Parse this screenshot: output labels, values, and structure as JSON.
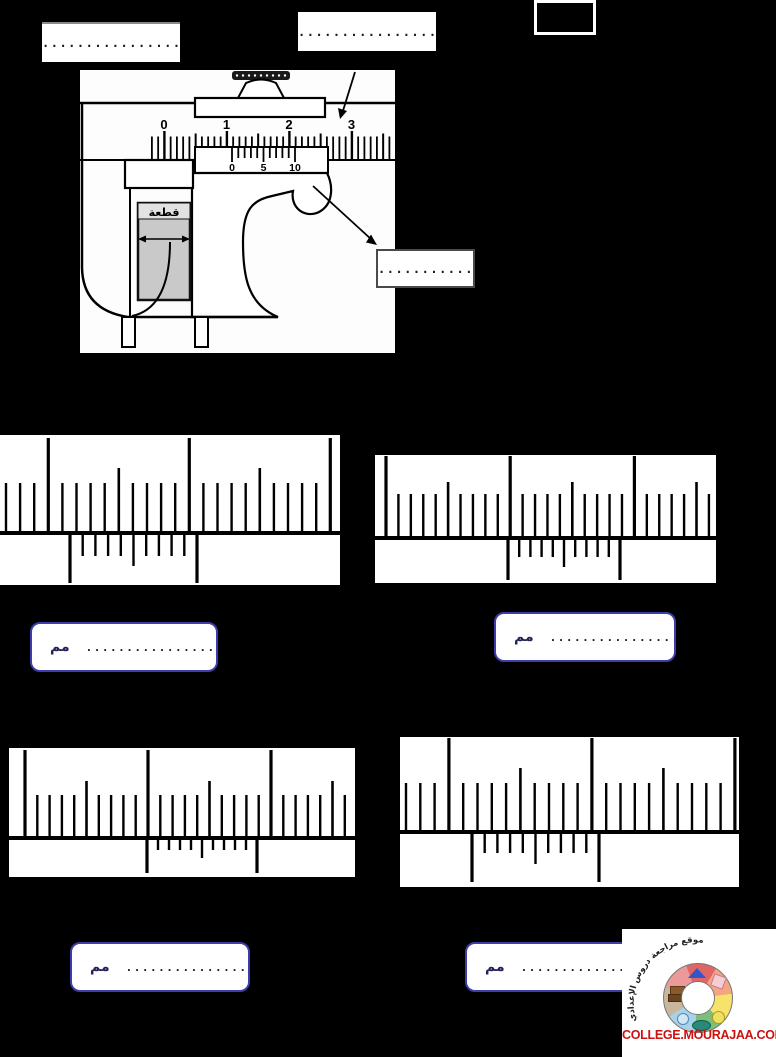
{
  "page": {
    "background": "#000000"
  },
  "top_labels": {
    "box1_dots": "............................",
    "box2_dots": "...........................",
    "score_box_value": ""
  },
  "caliper": {
    "main_scale_numbers": [
      "0",
      "1",
      "2",
      "3"
    ],
    "vernier_numbers": [
      "0",
      "5",
      "10"
    ],
    "piece_label": "قطعة",
    "pointer_box_dots": "................",
    "piece_color": "#c9c9c9",
    "geometry": {
      "main_cm_positions": [
        84,
        146.5,
        209,
        271.5
      ],
      "mm_spacing": 6.25,
      "vernier_tick_start": 152,
      "vernier_tick_spacing": 6.3
    }
  },
  "exercises": [
    {
      "name": "vernier-exercise-1",
      "geom": {
        "left": 0,
        "top": 435,
        "w": 340,
        "h": 150,
        "line_y": 98,
        "x0": 6,
        "s": 14.1,
        "phase": 3,
        "n": 24,
        "tall": 95,
        "mid": 65,
        "short": 50,
        "vx": 70,
        "vw": 127,
        "vlong": 50,
        "vshort": 23,
        "vmid": 33
      },
      "answer": {
        "unit": "مم",
        "dots": ".................................",
        "left": 30,
        "top": 622,
        "w": 188,
        "h": 50
      }
    },
    {
      "name": "vernier-exercise-2",
      "geom": {
        "left": 375,
        "top": 455,
        "w": 341,
        "h": 128,
        "line_y": 83,
        "x0": 11,
        "s": 12.42,
        "phase": 0,
        "n": 27,
        "tall": 82,
        "mid": 56,
        "short": 44,
        "vx": 133,
        "vw": 112,
        "vlong": 42,
        "vshort": 19,
        "vmid": 29
      },
      "answer": {
        "unit": "مم",
        "dots": "..............................",
        "left": 494,
        "top": 612,
        "w": 182,
        "h": 50
      }
    },
    {
      "name": "vernier-exercise-3",
      "geom": {
        "left": 9,
        "top": 748,
        "w": 346,
        "h": 129,
        "line_y": 90,
        "x0": 16,
        "s": 12.3,
        "phase": 0,
        "n": 27,
        "tall": 88,
        "mid": 57,
        "short": 43,
        "vx": 138,
        "vw": 110,
        "vlong": 35,
        "vshort": 12,
        "vmid": 20
      },
      "answer": {
        "unit": "مم",
        "dots": "........................",
        "left": 70,
        "top": 942,
        "w": 180,
        "h": 50
      }
    },
    {
      "name": "vernier-exercise-4",
      "geom": {
        "left": 400,
        "top": 737,
        "w": 339,
        "h": 150,
        "line_y": 95,
        "x0": 6,
        "s": 14.3,
        "phase": 3,
        "n": 24,
        "tall": 94,
        "mid": 64,
        "short": 49,
        "vx": 72,
        "vw": 127,
        "vlong": 50,
        "vshort": 21,
        "vmid": 32
      },
      "answer": {
        "unit": "مم",
        "dots": ".................................",
        "left": 465,
        "top": 942,
        "w": 183,
        "h": 50
      }
    }
  ],
  "logo": {
    "arc_text": "موقع مراجعة دروس الإعدادي",
    "site": "COLLEGE.MOURAJAA.COM",
    "site_color": "#cc1111",
    "ring_colors": [
      "#e06666",
      "#f4a582",
      "#f7e26b",
      "#7cbf7c",
      "#a8d1ea",
      "#c9b79c",
      "#eb9999"
    ]
  },
  "colors": {
    "answer_border": "#3d3dab",
    "ink": "#111111"
  }
}
